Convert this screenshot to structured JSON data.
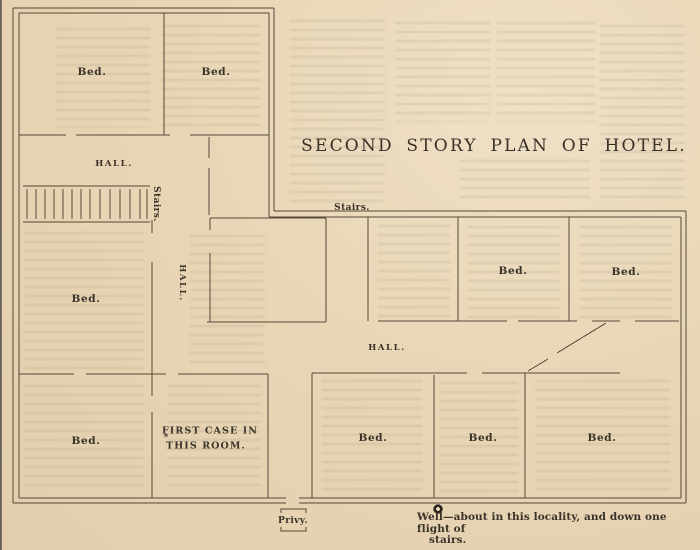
{
  "page": {
    "title": "SECOND STORY PLAN OF HOTEL.",
    "paper_color": "#e9d6b6",
    "ink_color": "#3a332a",
    "wall_line_color": "#55483a"
  },
  "plan": {
    "labels": [
      {
        "id": "bed-top-left",
        "text": "Bed.",
        "x": 92,
        "y": 72,
        "style": "room"
      },
      {
        "id": "bed-top-right",
        "text": "Bed.",
        "x": 216,
        "y": 72,
        "style": "room"
      },
      {
        "id": "hall-upper-left",
        "text": "HALL.",
        "x": 114,
        "y": 164,
        "style": "hall"
      },
      {
        "id": "stairs-left-vertical",
        "text": "Stairs.",
        "x": 156,
        "y": 204,
        "style": "small",
        "rotate": 90
      },
      {
        "id": "bed-mid-left",
        "text": "Bed.",
        "x": 86,
        "y": 299,
        "style": "room"
      },
      {
        "id": "hall-vertical",
        "text": "HALL.",
        "x": 182,
        "y": 283,
        "style": "hall",
        "rotate": 90
      },
      {
        "id": "stairs-top",
        "text": "Stairs.",
        "x": 352,
        "y": 208,
        "style": "small"
      },
      {
        "id": "bed-right-1",
        "text": "Bed.",
        "x": 513,
        "y": 271,
        "style": "room"
      },
      {
        "id": "bed-right-2",
        "text": "Bed.",
        "x": 626,
        "y": 272,
        "style": "room"
      },
      {
        "id": "hall-right",
        "text": "HALL.",
        "x": 387,
        "y": 348,
        "style": "hall"
      },
      {
        "id": "bed-bottom-left",
        "text": "Bed.",
        "x": 86,
        "y": 441,
        "style": "room"
      },
      {
        "id": "first-case-line1",
        "text": "FIRST CASE IN",
        "x": 210,
        "y": 431,
        "style": "note"
      },
      {
        "id": "first-case-line2",
        "text": "THIS ROOM.",
        "x": 206,
        "y": 446,
        "style": "note"
      },
      {
        "id": "first-case-mark",
        "text": "*",
        "x": 166,
        "y": 438,
        "style": "mark"
      },
      {
        "id": "bed-bottom-1",
        "text": "Bed.",
        "x": 373,
        "y": 438,
        "style": "room"
      },
      {
        "id": "bed-bottom-2",
        "text": "Bed.",
        "x": 483,
        "y": 438,
        "style": "room"
      },
      {
        "id": "bed-bottom-3",
        "text": "Bed.",
        "x": 602,
        "y": 438,
        "style": "room"
      },
      {
        "id": "privy",
        "text": "Privy.",
        "x": 293,
        "y": 521,
        "style": "small"
      }
    ],
    "notes": {
      "well_line1": "Well—about in this locality, and down one flight of",
      "well_line2": "stairs."
    }
  }
}
